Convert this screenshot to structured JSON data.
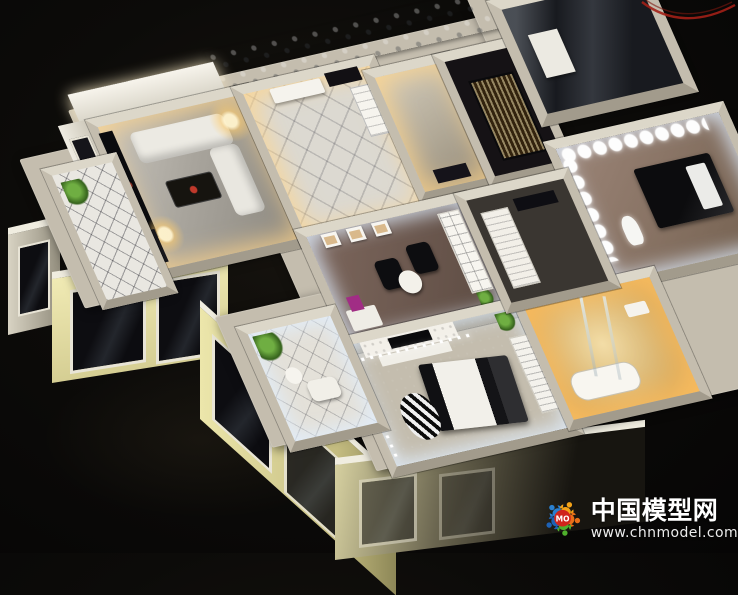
{
  "scene": {
    "subject": "Illuminated residential interior scale model on a dark table",
    "rooms": [
      "living-room",
      "foyer",
      "hallway-room",
      "gold-curtain-room",
      "stair-box",
      "bedroom-right",
      "study",
      "master-bedroom",
      "bathroom",
      "closet",
      "balcony-left",
      "balcony-bottom"
    ]
  },
  "colors": {
    "bg_center": "#17140f",
    "bg_edge": "#060505",
    "wall": "#c4bdae",
    "wall_light": "#dcd7c9",
    "wall_dark": "#a29b8c",
    "facade": "#ece6ab",
    "trim": "#f0ede0",
    "warm_glow": "#ffd88e",
    "cool_glow": "#e9f0ff",
    "wire": "#a32017",
    "wm_text": "#ffffff"
  },
  "watermark": {
    "site_name": "中国模型网",
    "site_url": "www.chnmodel.com",
    "logo_text": "MO",
    "logo_center_color": "#d0241c",
    "logo_figure_colors": [
      "#2a80d0",
      "#f5a318",
      "#e86f18",
      "#4fb02c",
      "#1d61b4"
    ]
  }
}
